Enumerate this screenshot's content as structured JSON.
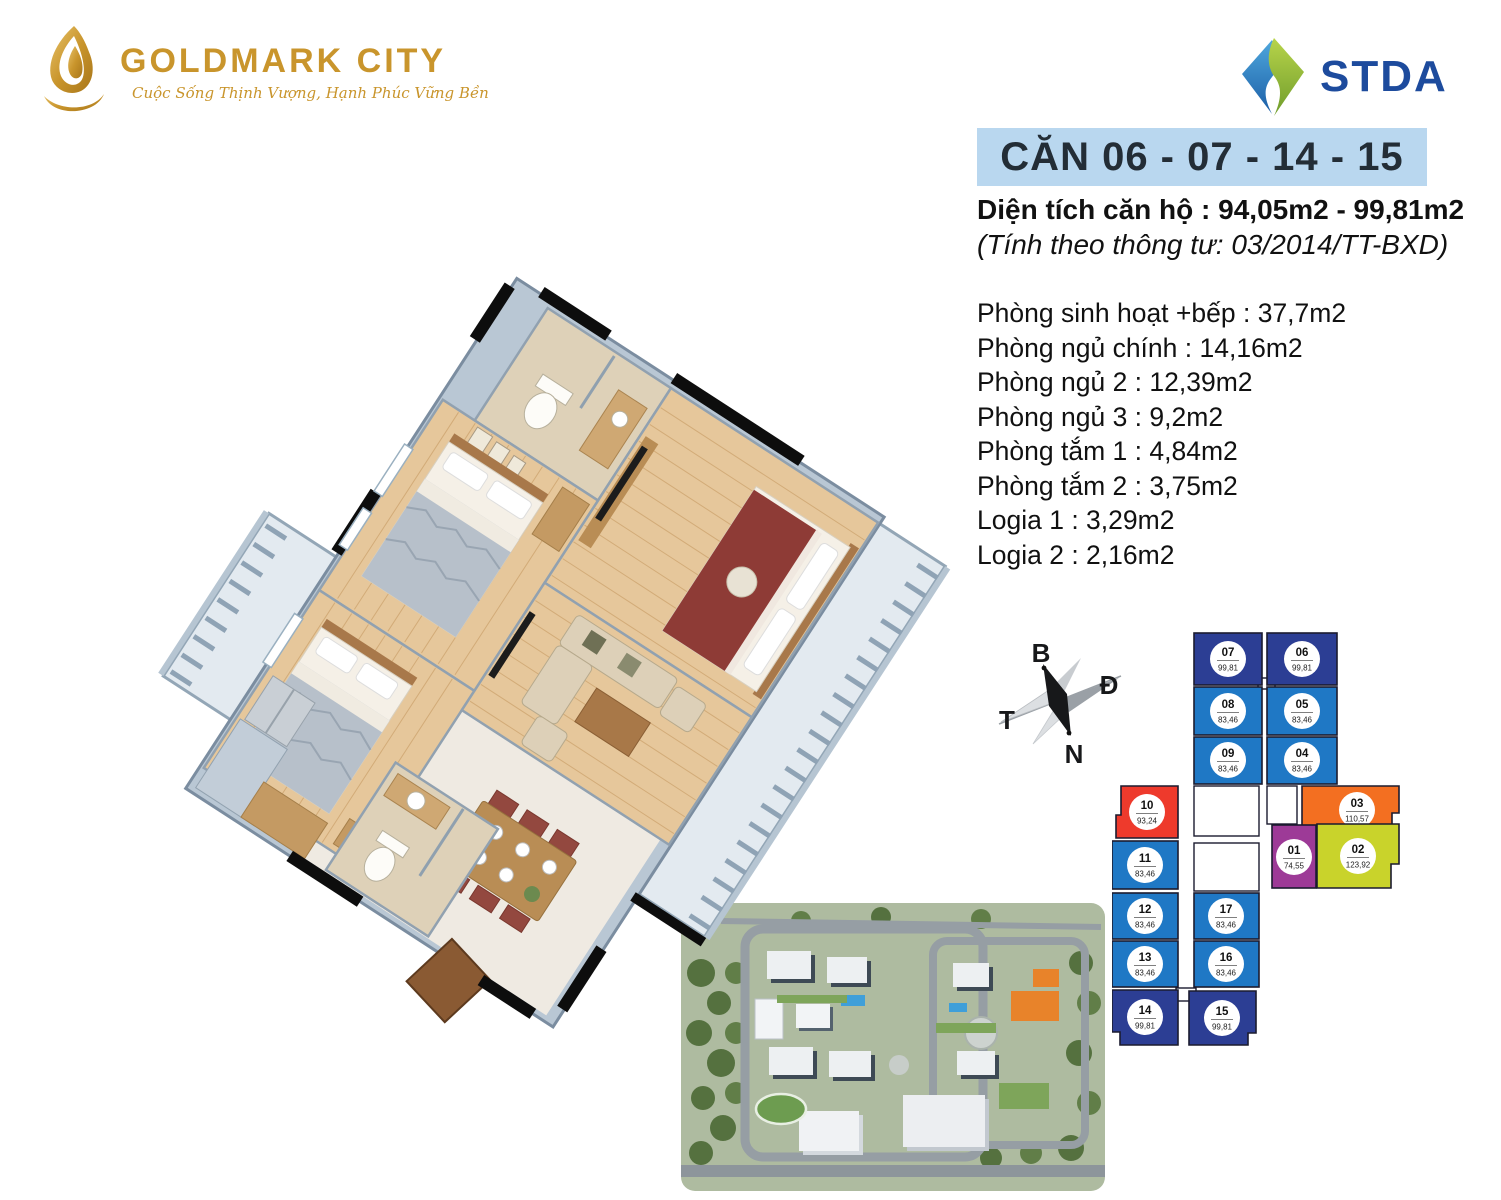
{
  "brand": {
    "name": "GOLDMARK CITY",
    "tagline": "Cuộc Sống Thịnh Vượng, Hạnh Phúc Vững Bền"
  },
  "partner": {
    "name": "STDA"
  },
  "header": {
    "title": "CĂN 06 - 07 - 14 - 15",
    "area_label": "Diện tích căn hộ :",
    "area_value": "94,05m2 - 99,81m2",
    "area_note": "(Tính theo thông tư: 03/2014/TT-BXD)"
  },
  "rooms": [
    {
      "label": "Phòng sinh hoạt +bếp",
      "value": "37,7m2"
    },
    {
      "label": "Phòng ngủ chính",
      "value": "14,16m2"
    },
    {
      "label": "Phòng ngủ 2",
      "value": "12,39m2"
    },
    {
      "label": "Phòng ngủ 3",
      "value": "9,2m2"
    },
    {
      "label": "Phòng tắm 1",
      "value": "4,84m2"
    },
    {
      "label": "Phòng tắm 2",
      "value": "3,75m2"
    },
    {
      "label": "Logia 1",
      "value": "3,29m2"
    },
    {
      "label": "Logia 2",
      "value": "2,16m2"
    }
  ],
  "compass": {
    "north_label": "B",
    "east_label": "Đ",
    "west_label": "T",
    "south_label": "N"
  },
  "palette": {
    "title_bar_bg": "#b9d7ef",
    "title_text": "#232d36",
    "brand_gold": "#c9952c",
    "stda_blue": "#1d4b9d",
    "body_text": "#111111"
  },
  "keyplan": {
    "highlight_units": [
      "06",
      "07",
      "14",
      "15"
    ],
    "colors": {
      "dark_blue": "#2c3e94",
      "blue": "#1f78c5",
      "red": "#ee3a2c",
      "orange": "#f36f21",
      "purple": "#9d3a97",
      "lime": "#c9d32b",
      "outline": "#1b1b2f"
    },
    "units": [
      {
        "id": "07",
        "area": "99,81",
        "color": "dark_blue",
        "x": 82,
        "y": 5,
        "w": 68,
        "h": 52,
        "cx": 116,
        "cy": 31
      },
      {
        "id": "06",
        "area": "99,81",
        "color": "dark_blue",
        "x": 155,
        "y": 5,
        "w": 70,
        "h": 52,
        "cx": 190,
        "cy": 31
      },
      {
        "id": "08",
        "area": "83,46",
        "color": "blue",
        "x": 82,
        "y": 59,
        "w": 68,
        "h": 48,
        "cx": 116,
        "cy": 83
      },
      {
        "id": "05",
        "area": "83,46",
        "color": "blue",
        "x": 155,
        "y": 59,
        "w": 70,
        "h": 48,
        "cx": 190,
        "cy": 83
      },
      {
        "id": "09",
        "area": "83,46",
        "color": "blue",
        "x": 82,
        "y": 109,
        "w": 68,
        "h": 47,
        "cx": 116,
        "cy": 132
      },
      {
        "id": "04",
        "area": "83,46",
        "color": "blue",
        "x": 155,
        "y": 109,
        "w": 70,
        "h": 47,
        "cx": 190,
        "cy": 132
      },
      {
        "id": "10",
        "area": "93,24",
        "color": "red",
        "points": "9,158 66,158 66,210 4,210 4,187 9,187",
        "cx": 35,
        "cy": 184
      },
      {
        "id": "03",
        "area": "110,57",
        "color": "orange",
        "points": "190,158 287,158 287,185 280,185 280,207 190,207",
        "cx": 245,
        "cy": 182
      },
      {
        "id": "11",
        "area": "83,46",
        "color": "blue",
        "x": 0,
        "y": 213,
        "w": 66,
        "h": 48,
        "cx": 33,
        "cy": 237
      },
      {
        "id": "01",
        "area": "74,55",
        "color": "purple",
        "x": 160,
        "y": 197,
        "w": 44,
        "h": 63,
        "cx": 182,
        "cy": 229
      },
      {
        "id": "02",
        "area": "123,92",
        "color": "lime",
        "points": "205,196 287,196 287,236 279,236 279,260 205,260",
        "cx": 246,
        "cy": 228
      },
      {
        "id": "12",
        "area": "83,46",
        "color": "blue",
        "x": 0,
        "y": 265,
        "w": 66,
        "h": 46,
        "cx": 33,
        "cy": 288
      },
      {
        "id": "17",
        "area": "83,46",
        "color": "blue",
        "x": 82,
        "y": 265,
        "w": 65,
        "h": 46,
        "cx": 114,
        "cy": 288
      },
      {
        "id": "13",
        "area": "83,46",
        "color": "blue",
        "x": 0,
        "y": 313,
        "w": 66,
        "h": 46,
        "cx": 33,
        "cy": 336
      },
      {
        "id": "16",
        "area": "83,46",
        "color": "blue",
        "x": 82,
        "y": 313,
        "w": 65,
        "h": 46,
        "cx": 114,
        "cy": 336
      },
      {
        "id": "14",
        "area": "99,81",
        "color": "dark_blue",
        "points": "0,362 66,362 66,417 8,417 8,404 0,404",
        "cx": 33,
        "cy": 389
      },
      {
        "id": "15",
        "area": "99,81",
        "color": "dark_blue",
        "points": "77,363 144,363 144,405 136,405 136,417 77,417",
        "cx": 110,
        "cy": 390
      }
    ],
    "service_blocks": [
      {
        "x": 82,
        "y": 158,
        "w": 65,
        "h": 50
      },
      {
        "x": 82,
        "y": 215,
        "w": 65,
        "h": 48
      },
      {
        "x": 155,
        "y": 158,
        "w": 30,
        "h": 38
      },
      {
        "x": 146,
        "y": 50,
        "w": 17,
        "h": 11
      },
      {
        "x": 64,
        "y": 360,
        "w": 20,
        "h": 13
      }
    ]
  }
}
